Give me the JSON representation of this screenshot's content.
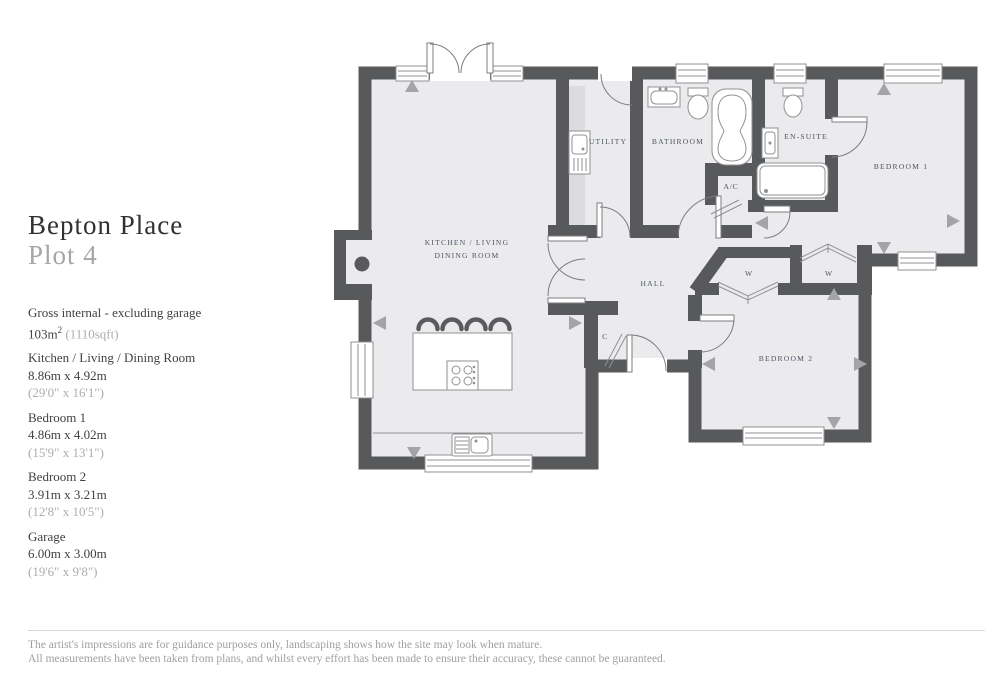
{
  "title": "Bepton Place",
  "subtitle": "Plot 4",
  "specs": {
    "gross": {
      "label": "Gross internal - excluding garage",
      "metric": "103m",
      "metric_sup": "2",
      "imperial": "(1110sqft)"
    },
    "items": [
      {
        "name": "Kitchen / Living / Dining Room",
        "metric": "8.86m x 4.92m",
        "imperial": "(29'0\" x 16'1\")"
      },
      {
        "name": "Bedroom 1",
        "metric": "4.86m x 4.02m",
        "imperial": "(15'9\" x 13'1\")"
      },
      {
        "name": "Bedroom 2",
        "metric": "3.91m x 3.21m",
        "imperial": "(12'8\" x 10'5\")"
      },
      {
        "name": "Garage",
        "metric": "6.00m x 3.00m",
        "imperial": "(19'6\" x 9'8\")"
      }
    ]
  },
  "plan": {
    "rooms": {
      "kitchen_line1": "KITCHEN / LIVING",
      "kitchen_line2": "DINING ROOM",
      "utility": "UTILITY",
      "bathroom": "BATHROOM",
      "ensuite": "EN-SUITE",
      "ac": "A/C",
      "bedroom1": "BEDROOM 1",
      "hall": "HALL",
      "wardrobe": "W",
      "cupboard": "C",
      "bedroom2": "BEDROOM 2"
    },
    "colors": {
      "wall": "#58595b",
      "floor": "#ebebed",
      "fixture_stroke": "#8f9194",
      "marker": "#a3a4a6",
      "label": "#4e5663"
    }
  },
  "footer": {
    "line1": "The artist's impressions are for guidance purposes only, landscaping shows how the site may look when mature.",
    "line2": "All measurements have been taken from plans, and whilst every effort has been made to ensure their accuracy, these cannot be guaranteed."
  }
}
